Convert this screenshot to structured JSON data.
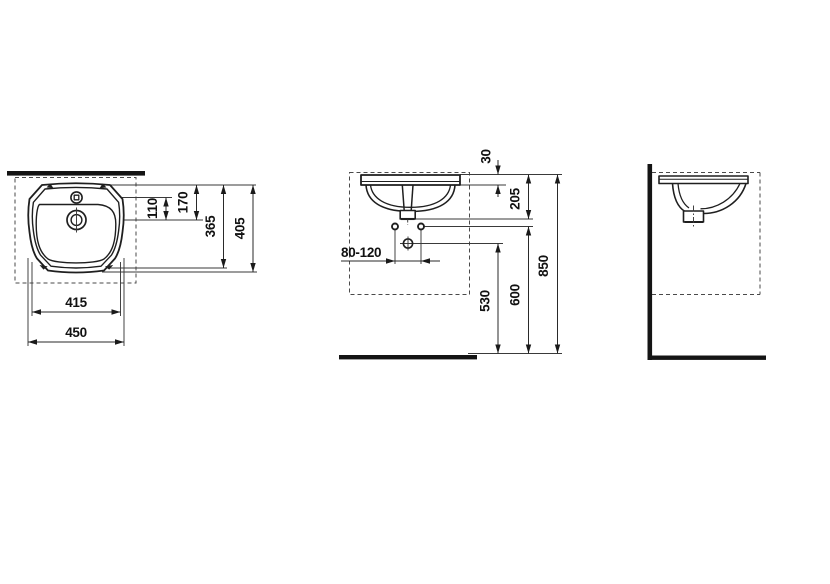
{
  "page": {
    "background": "#ffffff",
    "line_color": "#1f1f1f",
    "bar_color": "#141414"
  },
  "views": {
    "top": "top-view",
    "front": "front-view",
    "side": "side-view"
  },
  "dimensions": {
    "tap_to_drain": "110",
    "front_edge_to_drain": "170",
    "basin_depth": "365",
    "overall_depth": "405",
    "basin_width": "415",
    "overall_width": "450",
    "rim_thickness": "30",
    "rim_to_outlet": "205",
    "fixing_hole_range": "80-120",
    "trap_outlet_height": "530",
    "fixing_hole_height": "600",
    "rim_height": "850"
  }
}
